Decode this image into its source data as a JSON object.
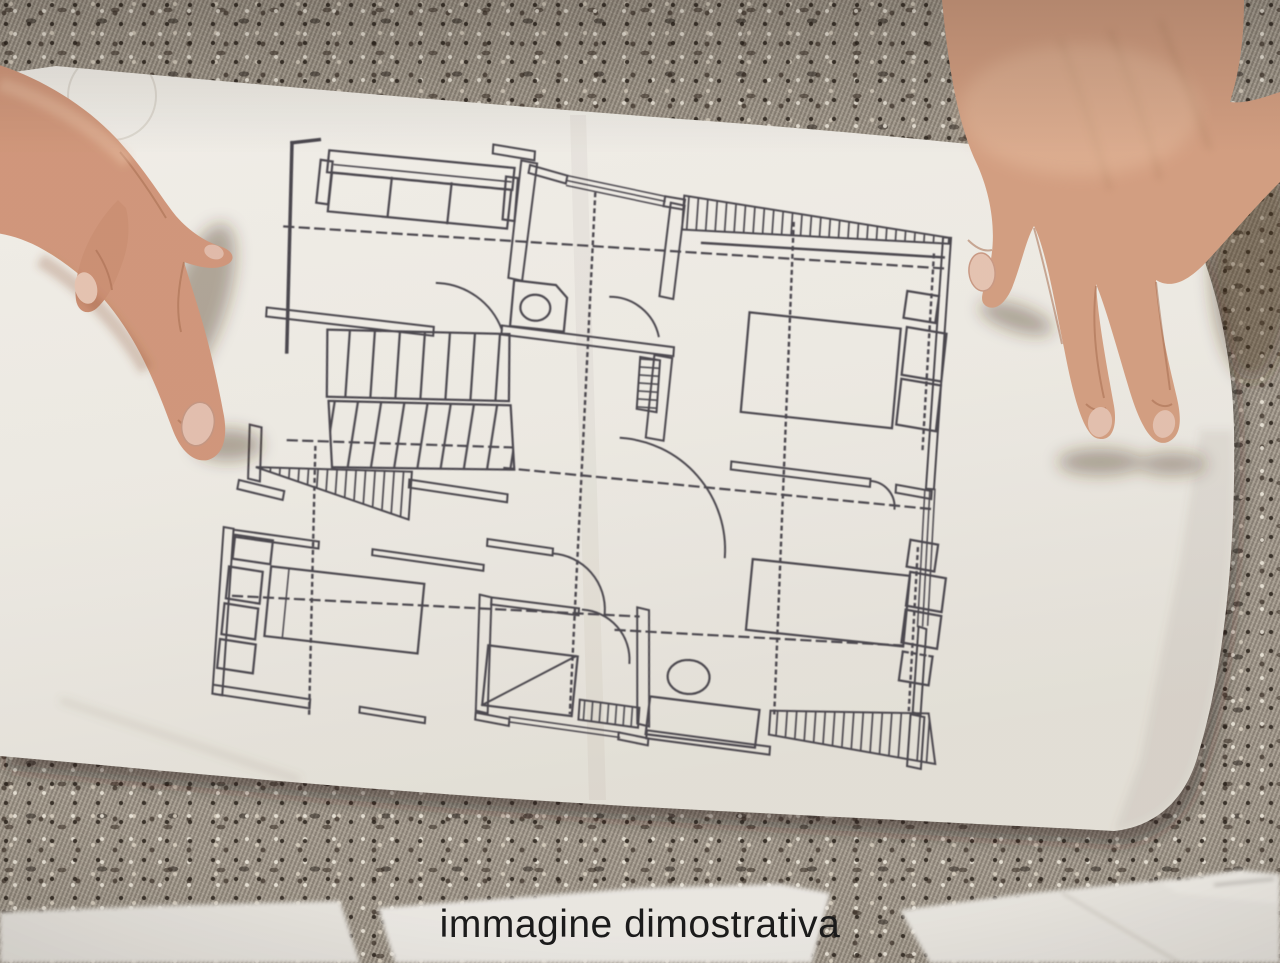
{
  "caption": {
    "text": "immagine dimostrativa",
    "color": "#1b1b1b"
  },
  "photo": {
    "subject": "two hands presenting an architectural floor plan sheet lying on a woven carpet",
    "elements": [
      "woven-carpet",
      "floor-plan-sheet",
      "left-hand",
      "right-hand",
      "loose-papers",
      "caption-overlay"
    ],
    "floor_plan_features": [
      "sofa",
      "staircase-flights",
      "under-stair-hatch",
      "balcony-hatch-strip",
      "wc-with-basin",
      "double-bed-with-nightstands",
      "second-bed",
      "third-bed",
      "wardrobe-units",
      "shower-with-diagonal",
      "oval-tub",
      "vanity",
      "ramp-hatch",
      "door-swing-arcs",
      "dashed-axis-lines",
      "dotted-section-lines",
      "windows-double-lines"
    ],
    "colors": {
      "paper": "#f3f1ec",
      "plan_ink": "#4a4750",
      "carpet_base": "#9e968a",
      "carpet_dark": "#352e28",
      "carpet_light": "#e3dbcc",
      "skin_left": "#d49a7e",
      "skin_right": "#d6a184",
      "nail": "#e9c7b6",
      "caption_text": "#1b1b1b"
    }
  }
}
